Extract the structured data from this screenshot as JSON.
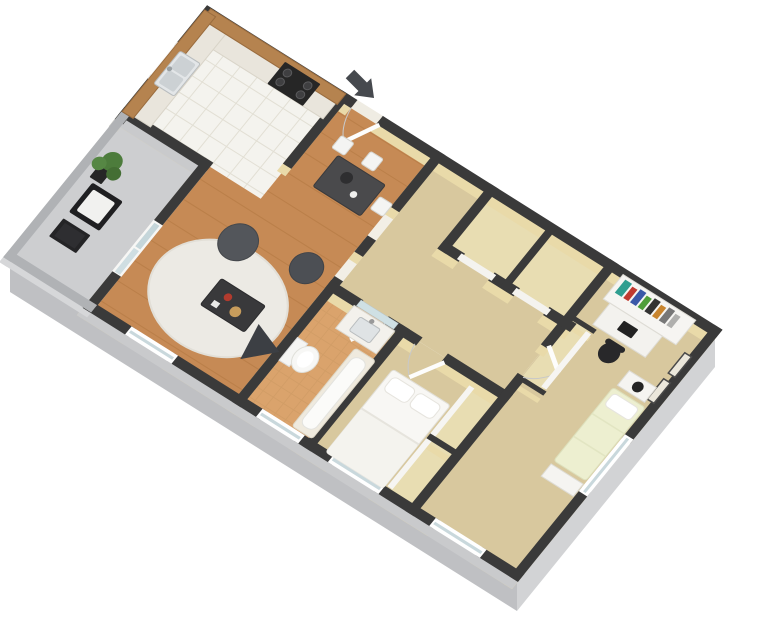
{
  "scene": {
    "type": "3d-floor-plan",
    "description": "Isometric 3D dollhouse rendering of a two-bedroom one-bath apartment floor plan on a white background, entry at top with a dark arrow marker",
    "view": "rotated isometric",
    "bedrooms": 2,
    "bathrooms": 1
  },
  "colors": {
    "background": "#ffffff",
    "wall_cap": "#3a3a3a",
    "wall_face": "#e9daa9",
    "wall_exterior": "#c9cacc",
    "patio_wall_cap": "#b0b2b5",
    "patio_wall_face": "#d6d7d9",
    "plinth_left": "#bfc0c3",
    "plinth_right": "#d2d3d5",
    "plinth_back": "#c9cacc",
    "wood_floor": "#c68a55",
    "wood_plank_line": "#b1763f",
    "tile_floor": "#f4f3ee",
    "tile_line": "#e2dfd4",
    "carpet_floor": "#d8c89e",
    "closet_floor": "#e8ddb2",
    "bath_floor": "#daa36c",
    "bath_tile_line": "#cd9a64",
    "patio_floor": "#cdced0",
    "rug": "#eceae4",
    "cabinet_wood": "#b5834f",
    "countertop": "#e9e5dc",
    "appliance_dark": "#262626",
    "furniture_dark": "#4a4a4c",
    "beanbag": "#53565b",
    "white_furniture": "#f5f4f1",
    "bedding_white": "#f8f7f4",
    "bedding_green": "#edefd0",
    "glass": "#c9d8dc",
    "plant": "#4d7c3c",
    "arrow": "#46494e"
  },
  "entry": {
    "marker": "entry-arrow",
    "points_to": "front door"
  },
  "rooms": [
    {
      "label": "Kitchen",
      "floor": "white tile",
      "features": [
        "L-shaped oak cabinets with white countertop",
        "double-basin sink under window",
        "black range oven",
        "upper cabinets"
      ]
    },
    {
      "label": "Dining Area",
      "floor": "hardwood",
      "features": [
        "dark rectangular dining table",
        "three white chairs",
        "centerpiece bowl"
      ]
    },
    {
      "label": "Living Room",
      "floor": "hardwood",
      "features": [
        "white shag rug",
        "dark coffee table with red and tan decor",
        "two charcoal beanbag chairs",
        "dark floor cushion",
        "two cased openings to hallway"
      ]
    },
    {
      "label": "Patio",
      "floor": "concrete",
      "features": [
        "black lounge chair with white cushion",
        "black side table",
        "potted plant",
        "sliding glass door"
      ]
    },
    {
      "label": "Hallway",
      "floor": "carpet",
      "features": [
        "two double closets with white doors"
      ]
    },
    {
      "label": "Bathroom",
      "floor": "terracotta tile",
      "features": [
        "white vanity with sink and mirror",
        "toilet",
        "bathtub",
        "window"
      ]
    },
    {
      "label": "Bedroom 1",
      "floor": "carpet",
      "features": [
        "double bed with two white pillows",
        "sliding-door closet",
        "window"
      ]
    },
    {
      "label": "Bedroom 2",
      "floor": "carpet",
      "features": [
        "white desk with hutch bookshelf and colorful books",
        "black office chair",
        "single bed with pale green bedding",
        "nightstand with black lamp",
        "bench",
        "sliding-door closet",
        "two framed wall pictures",
        "corner windows"
      ]
    }
  ],
  "floorplan": {
    "width_px": 768,
    "height_px": 622
  }
}
